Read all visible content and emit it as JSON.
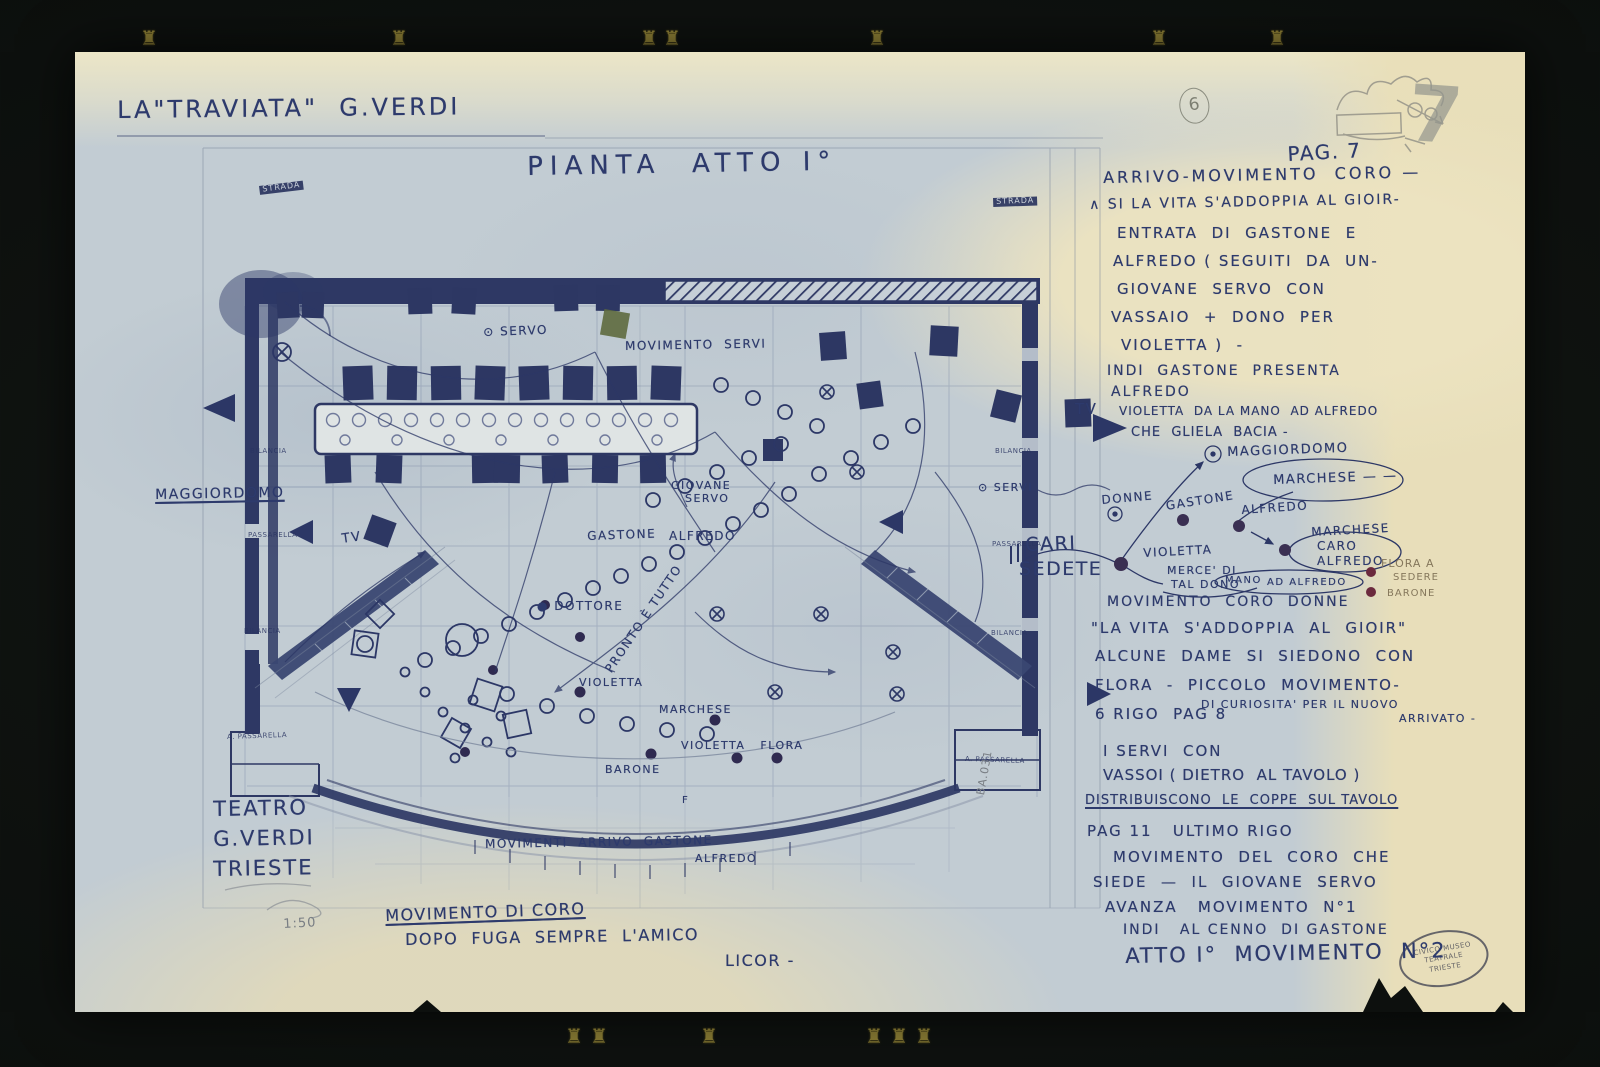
{
  "header": {
    "title": "LA\"TRAVIATA\"  G.VERDI",
    "sheet_number_circled": "6",
    "page_pencil": "7"
  },
  "plan": {
    "title": "PIANTA  ATTO I°"
  },
  "theater": {
    "line1": "TEATRO",
    "line2": "G.VERDI",
    "line3": "TRIESTE",
    "scale": "1:50"
  },
  "stamp": {
    "line1": "CIVICO MUSEO",
    "line2": "TEATRALE",
    "line3": "TRIESTE"
  },
  "colors": {
    "ink": "#2d3a6c",
    "pencil": "#797e84",
    "paper_blue": "#c2ccd3",
    "paper_cream": "#e9dfbd",
    "dark_fill": "#2e3864",
    "dot_maroon": "#6b2a3e"
  },
  "decor": {
    "glyph": "♜",
    "top_x": [
      140,
      390,
      640,
      663,
      868,
      1150,
      1268
    ],
    "top_y": 26,
    "bottom_x": [
      565,
      590,
      700,
      865,
      890,
      915
    ],
    "bottom_y": 1024
  },
  "plan_labels": [
    {
      "n": "servo-label",
      "t": "⊙ SERVO",
      "x": 408,
      "y": 274,
      "s": 12,
      "r": -2
    },
    {
      "n": "movimento-servi-label",
      "t": "MOVIMENTO  SERVI",
      "x": 550,
      "y": 288,
      "s": 12,
      "r": -1
    },
    {
      "n": "maggiordomo-left-label",
      "t": "MAGGIORDOMO",
      "x": 80,
      "y": 436,
      "s": 14,
      "u": 1,
      "r": -1
    },
    {
      "n": "tv-left-label",
      "t": "TV",
      "x": 266,
      "y": 481,
      "s": 13,
      "r": -8
    },
    {
      "n": "tv-right-label",
      "t": "TV",
      "x": 1000,
      "y": 350,
      "s": 15
    },
    {
      "n": "giovane-servo-label-1",
      "t": "GIOVANE",
      "x": 596,
      "y": 428,
      "s": 11
    },
    {
      "n": "giovane-servo-label-2",
      "t": "SERVO",
      "x": 610,
      "y": 441,
      "s": 11
    },
    {
      "n": "gastone-label",
      "t": "GASTONE",
      "x": 512,
      "y": 478,
      "s": 12,
      "r": -2
    },
    {
      "n": "alfredo-label",
      "t": "ALFREDO",
      "x": 594,
      "y": 478,
      "s": 12
    },
    {
      "n": "servi-right-label",
      "t": "⊙ SERVI",
      "x": 903,
      "y": 430,
      "s": 11
    },
    {
      "n": "dottore-label",
      "t": "● DOTTORE",
      "x": 462,
      "y": 548,
      "s": 12
    },
    {
      "n": "pronto-e-tutto-label",
      "t": "PRONTO È TUTTO",
      "x": 528,
      "y": 616,
      "s": 12,
      "r": -56
    },
    {
      "n": "violetta-label",
      "t": "VIOLETTA",
      "x": 504,
      "y": 625,
      "s": 11
    },
    {
      "n": "marchese-label",
      "t": "MARCHESE",
      "x": 584,
      "y": 652,
      "s": 11
    },
    {
      "n": "violetta-flora-label",
      "t": "VIOLETTA   FLORA",
      "x": 606,
      "y": 688,
      "s": 11
    },
    {
      "n": "barone-label",
      "t": "BARONE",
      "x": 530,
      "y": 712,
      "s": 11
    },
    {
      "n": "f-mark",
      "t": "F",
      "x": 607,
      "y": 744,
      "s": 10
    },
    {
      "n": "movimenti-arrivo-label-1",
      "t": "MOVIMENTI  ARRIVO  GASTONE",
      "x": 410,
      "y": 786,
      "s": 12,
      "r": -1
    },
    {
      "n": "movimenti-arrivo-label-2",
      "t": "ALFREDO",
      "x": 620,
      "y": 801,
      "s": 11
    },
    {
      "n": "movimento-di-coro-label",
      "t": "MOVIMENTO DI CORO",
      "x": 310,
      "y": 856,
      "s": 16,
      "u": 1,
      "r": -2
    },
    {
      "n": "dopo-fuga-label",
      "t": "DOPO  FUGA  SEMPRE  L'AMICO",
      "x": 330,
      "y": 880,
      "s": 16,
      "r": -1
    },
    {
      "n": "licor-label",
      "t": "LICOR -",
      "x": 650,
      "y": 901,
      "s": 16
    },
    {
      "n": "strada-left-tag",
      "t": "STRADA",
      "x": 184,
      "y": 134,
      "s": 8,
      "cls": "boxed",
      "r": -7
    },
    {
      "n": "strada-right-tag",
      "t": "STRADA",
      "x": 918,
      "y": 146,
      "s": 8,
      "cls": "boxed",
      "r": -2
    },
    {
      "n": "bilancia-left-1",
      "t": "BILANCIA",
      "x": 175,
      "y": 396,
      "s": 7,
      "cls": "tinyprint"
    },
    {
      "n": "passarella-left-1",
      "t": "PASSARELLA",
      "x": 173,
      "y": 480,
      "s": 7,
      "cls": "tinyprint"
    },
    {
      "n": "bilancia-left-2",
      "t": "BILANCIA",
      "x": 169,
      "y": 576,
      "s": 7,
      "cls": "tinyprint"
    },
    {
      "n": "passarella-left-2",
      "t": "A. PASSARELLA",
      "x": 152,
      "y": 682,
      "s": 7,
      "cls": "tinyprint",
      "r": -2
    },
    {
      "n": "bilancia-right-1",
      "t": "BILANCIA",
      "x": 920,
      "y": 396,
      "s": 7,
      "cls": "tinyprint"
    },
    {
      "n": "passarella-right-1",
      "t": "PASSARELLA",
      "x": 917,
      "y": 489,
      "s": 7,
      "cls": "tinyprint"
    },
    {
      "n": "bilancia-right-2",
      "t": "BILANCIA",
      "x": 916,
      "y": 578,
      "s": 7,
      "cls": "tinyprint"
    },
    {
      "n": "passarella-right-2",
      "t": "A. PASSARELLA",
      "x": 890,
      "y": 704,
      "s": 7,
      "cls": "tinyprint",
      "r": 2
    },
    {
      "n": "pencil-rotated-note",
      "t": "BA.031",
      "x": 900,
      "y": 742,
      "s": 11,
      "cls": "pencil",
      "r": -80
    }
  ],
  "margin_notes": [
    {
      "n": "pag-7-note",
      "t": "PAG. 7",
      "x": 1212,
      "y": 92,
      "s": 20,
      "r": -3
    },
    {
      "n": "note-arrivo",
      "t": "ARRIVO-MOVIMENTO  CORO —",
      "x": 1028,
      "y": 118,
      "s": 16,
      "ls": 3,
      "r": -1
    },
    {
      "n": "note-si-la-vita",
      "t": "∧ SI LA VITA S'ADDOPPIA AL GIOIR-",
      "x": 1014,
      "y": 146,
      "s": 14,
      "ls": 2,
      "r": -1
    },
    {
      "n": "note-entrata",
      "t": "ENTRATA  DI  GASTONE  E",
      "x": 1042,
      "y": 174,
      "s": 15,
      "ls": 2
    },
    {
      "n": "note-alfredo-seguiti",
      "t": "ALFREDO ( SEGUITI  DA  UN-",
      "x": 1038,
      "y": 202,
      "s": 15,
      "ls": 2
    },
    {
      "n": "note-giovane-servo",
      "t": "GIOVANE  SERVO  CON",
      "x": 1042,
      "y": 230,
      "s": 15,
      "ls": 2
    },
    {
      "n": "note-vassaio",
      "t": "VASSAIO  +  DONO  PER",
      "x": 1036,
      "y": 258,
      "s": 15,
      "ls": 2
    },
    {
      "n": "note-violetta-par",
      "t": "VIOLETTA )  -",
      "x": 1046,
      "y": 286,
      "s": 15,
      "ls": 2
    },
    {
      "n": "note-indi-gastone",
      "t": "INDI  GASTONE  PRESENTA",
      "x": 1032,
      "y": 312,
      "s": 14,
      "ls": 2
    },
    {
      "n": "note-alfredo2",
      "t": "ALFREDO",
      "x": 1036,
      "y": 333,
      "s": 14,
      "ls": 2
    },
    {
      "n": "note-violetta-mano",
      "t": "VIOLETTA  DA LA MANO  AD ALFREDO",
      "x": 1044,
      "y": 353,
      "s": 12,
      "ls": 1
    },
    {
      "n": "note-che-gliela",
      "t": "CHE  GLIELA  BACIA -",
      "x": 1056,
      "y": 374,
      "s": 13,
      "ls": 1
    },
    {
      "n": "cluster-maggiordomo",
      "t": "MAGGIORDOMO",
      "x": 1152,
      "y": 394,
      "s": 13,
      "r": -2
    },
    {
      "n": "cluster-marchese-oval",
      "t": "MARCHESE — —",
      "x": 1198,
      "y": 422,
      "s": 13,
      "r": -2
    },
    {
      "n": "cluster-donne",
      "t": "DONNE",
      "x": 1026,
      "y": 442,
      "s": 12,
      "r": -5
    },
    {
      "n": "cluster-gastone",
      "t": "GASTONE",
      "x": 1090,
      "y": 448,
      "s": 12,
      "r": -9
    },
    {
      "n": "cluster-alfredo",
      "t": "ALFREDO",
      "x": 1166,
      "y": 452,
      "s": 12,
      "r": -4
    },
    {
      "n": "cluster-marchese2",
      "t": "MARCHESE",
      "x": 1236,
      "y": 474,
      "s": 12,
      "r": -3
    },
    {
      "n": "cluster-caro",
      "t": "CARO",
      "x": 1242,
      "y": 488,
      "s": 12
    },
    {
      "n": "cluster-caro-alfredo",
      "t": "ALFREDO",
      "x": 1242,
      "y": 503,
      "s": 12
    },
    {
      "n": "cluster-violetta",
      "t": "VIOLETTA",
      "x": 1068,
      "y": 495,
      "s": 12,
      "r": -3
    },
    {
      "n": "cluster-cari",
      "t": "CARI",
      "x": 950,
      "y": 484,
      "s": 19,
      "r": -2
    },
    {
      "n": "cluster-sedete",
      "t": "SEDETE",
      "x": 944,
      "y": 508,
      "s": 19
    },
    {
      "n": "cluster-merce",
      "t": "MERCE' DI",
      "x": 1092,
      "y": 513,
      "s": 11
    },
    {
      "n": "cluster-tal-dono",
      "t": "TAL DONO",
      "x": 1096,
      "y": 527,
      "s": 11
    },
    {
      "n": "cluster-mano",
      "t": "MANO",
      "x": 1150,
      "y": 524,
      "s": 10
    },
    {
      "n": "cluster-ad-alfredo",
      "t": "AD ALFREDO",
      "x": 1192,
      "y": 526,
      "s": 10
    },
    {
      "n": "cluster-flora-a",
      "t": "FLORA A",
      "x": 1306,
      "y": 506,
      "s": 11,
      "cls": "tan"
    },
    {
      "n": "cluster-sedere",
      "t": "SEDERE",
      "x": 1318,
      "y": 521,
      "s": 10,
      "cls": "tan"
    },
    {
      "n": "cluster-barone",
      "t": "BARONE",
      "x": 1312,
      "y": 537,
      "s": 10,
      "cls": "tan"
    },
    {
      "n": "note-mov-coro-donne",
      "t": "MOVIMENTO  CORO  DONNE",
      "x": 1032,
      "y": 543,
      "s": 14,
      "ls": 2
    },
    {
      "n": "note-la-vita",
      "t": "\"LA VITA  S'ADDOPPIA  AL  GIOIR\"",
      "x": 1016,
      "y": 569,
      "s": 15,
      "ls": 2
    },
    {
      "n": "note-alcune-dame",
      "t": "ALCUNE  DAME  SI  SIEDONO  CON",
      "x": 1020,
      "y": 597,
      "s": 15,
      "ls": 2
    },
    {
      "n": "note-flora-piccolo",
      "t": "FLORA  -  PICCOLO  MOVIMENTO-",
      "x": 1020,
      "y": 626,
      "s": 15,
      "ls": 2
    },
    {
      "n": "note-di-curiosita",
      "t": "DI CURIOSITA' PER IL NUOVO",
      "x": 1126,
      "y": 647,
      "s": 11
    },
    {
      "n": "note-6-rigo",
      "t": "6 RIGO  PAG 8",
      "x": 1020,
      "y": 655,
      "s": 15,
      "ls": 2
    },
    {
      "n": "note-arrivato",
      "t": "ARRIVATO -",
      "x": 1324,
      "y": 661,
      "s": 11
    },
    {
      "n": "note-i-servi",
      "t": "I SERVI  CON",
      "x": 1028,
      "y": 692,
      "s": 15,
      "ls": 2
    },
    {
      "n": "note-vassoi",
      "t": "VASSOI ( DIETRO  AL TAVOLO )",
      "x": 1028,
      "y": 716,
      "s": 15,
      "ls": 1
    },
    {
      "n": "note-distribuiscono",
      "t": "DISTRIBUISCONO  LE  COPPE  SUL TAVOLO",
      "x": 1010,
      "y": 742,
      "s": 13,
      "u": 1,
      "ls": 1
    },
    {
      "n": "note-pag-11",
      "t": "PAG 11   ULTIMO RIGO",
      "x": 1012,
      "y": 772,
      "s": 15,
      "ls": 2
    },
    {
      "n": "note-mov-del-coro",
      "t": "MOVIMENTO  DEL  CORO  CHE",
      "x": 1038,
      "y": 798,
      "s": 15,
      "ls": 2
    },
    {
      "n": "note-siede",
      "t": "SIEDE  —  IL  GIOVANE  SERVO",
      "x": 1018,
      "y": 823,
      "s": 15,
      "ls": 2
    },
    {
      "n": "note-avanza",
      "t": "AVANZA   MOVIMENTO  N°1",
      "x": 1030,
      "y": 848,
      "s": 15,
      "ls": 2
    },
    {
      "n": "note-indi-al-cenno",
      "t": "INDI   AL CENNO  DI GASTONE",
      "x": 1048,
      "y": 871,
      "s": 14,
      "ls": 2
    },
    {
      "n": "note-atto-1-mov-2",
      "t": "ATTO I°  MOVIMENTO  N°2",
      "x": 1050,
      "y": 893,
      "s": 21,
      "ls": 2,
      "r": -1
    }
  ]
}
